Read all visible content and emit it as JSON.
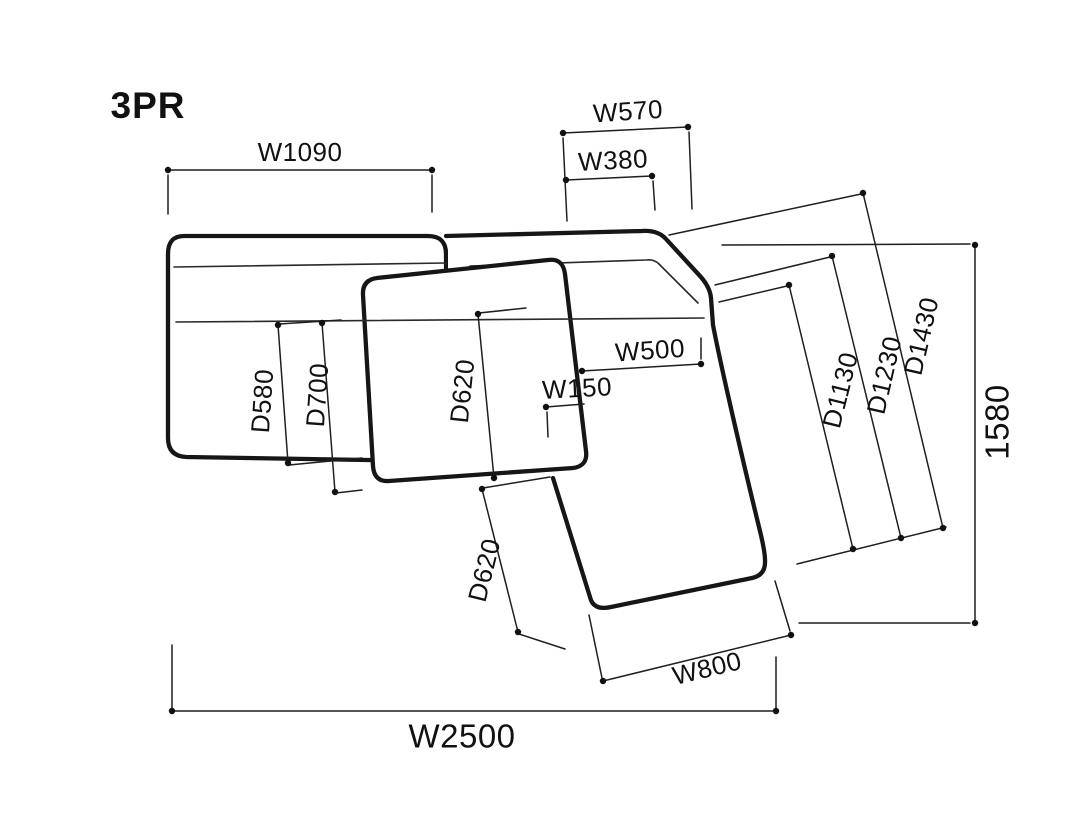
{
  "page": {
    "title_label": "3PR"
  },
  "dimensions": {
    "w1090": "W1090",
    "w570": "W570",
    "w380": "W380",
    "w500": "W500",
    "w150": "W150",
    "d580": "D580",
    "d700": "D700",
    "d620_middle_seat": "D620",
    "d620_footrest": "D620",
    "d1130": "D1130",
    "d1230": "D1230",
    "d1430": "D1430",
    "total_depth_1580": "1580",
    "w800": "W800",
    "w2500": "W2500"
  },
  "colors": {
    "line": "#1a1a1a",
    "background": "#ffffff"
  }
}
